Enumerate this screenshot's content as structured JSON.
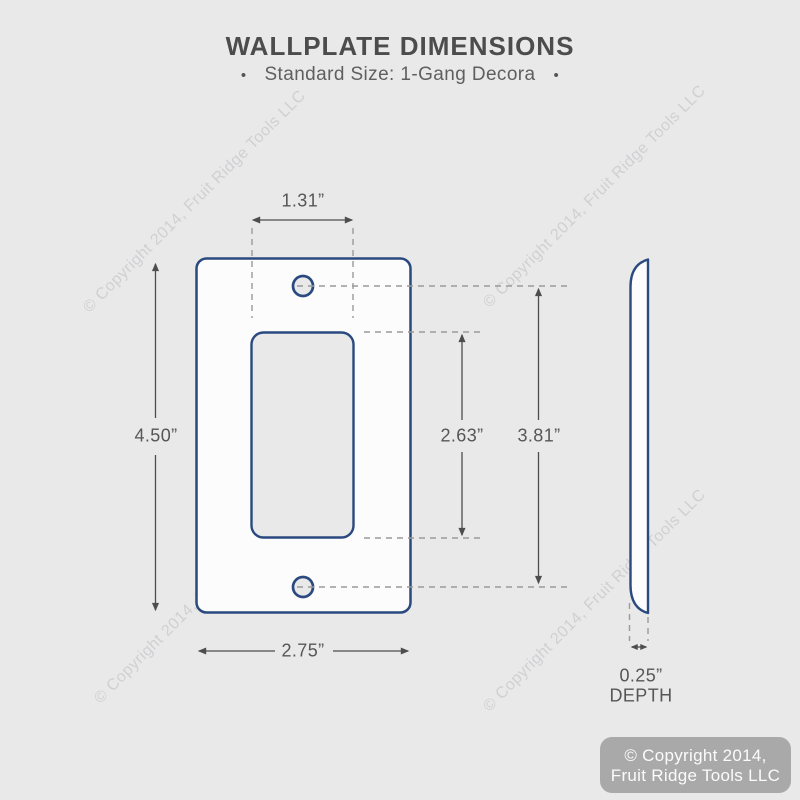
{
  "header": {
    "title": "WALLPLATE DIMENSIONS",
    "bullet_left": "•",
    "subtitle": "Standard Size: 1-Gang Decora",
    "bullet_right": "•"
  },
  "dimensions": {
    "opening_width": "1.31”",
    "plate_height": "4.50”",
    "opening_height": "2.63”",
    "screw_spacing": "3.81”",
    "plate_width": "2.75”",
    "depth_value": "0.25”",
    "depth_label": "DEPTH"
  },
  "watermark": {
    "text": "© Copyright 2014, Fruit Ridge Tools LLC"
  },
  "footer_badge": {
    "line1": "© Copyright 2014,",
    "line2": "Fruit Ridge Tools LLC"
  },
  "colors": {
    "background": "#e9e9ea",
    "plate_outline_blue": "#2a4a7f",
    "dimension_gray": "#4d4d4d",
    "dashed_gray": "#9a9a9a",
    "badge_background": "#a9a9a9",
    "badge_text": "#fbfbfb"
  }
}
